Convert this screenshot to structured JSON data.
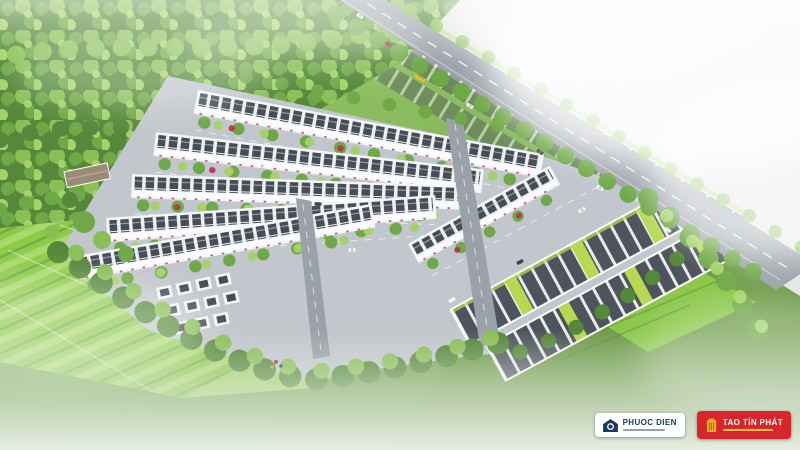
{
  "scene_labels": {
    "phuoc_dien": {
      "name": "PHUOC DIEN",
      "icon": "house-swirl-icon"
    },
    "tao_tin_phat": {
      "name": "TAO TÍN PHÁT",
      "icon": "gold-building-icon"
    }
  },
  "brand": {
    "phuoc_dien": {
      "name": "PHUOC DIEN"
    },
    "tao_tin_phat": {
      "name": "TAO TÍN PHÁT"
    }
  },
  "colors": {
    "house_white": "#f4f6f8",
    "facade": "#fbfcfd",
    "roof_frame": "#edf0f2",
    "roof_dark": "#474d57",
    "estate_base": "#c2c7cd",
    "road_gray": "#9aa1a9",
    "forest_1": "#55883a",
    "forest_2": "#6fa847",
    "forest_3": "#8abf55",
    "forest_4": "#a4d269",
    "field_bright": "#8ccb4a",
    "field_light": "#aad86b",
    "field_olive": "#6f9c49",
    "field_dark": "#5a8a3e",
    "plot_dark": "#4e545d",
    "plot_grass": "#b5da52",
    "tree_red": "#c02c48",
    "navy": "#1b3a63",
    "brand_red": "#d7262c",
    "gold": "#f2b01e"
  }
}
